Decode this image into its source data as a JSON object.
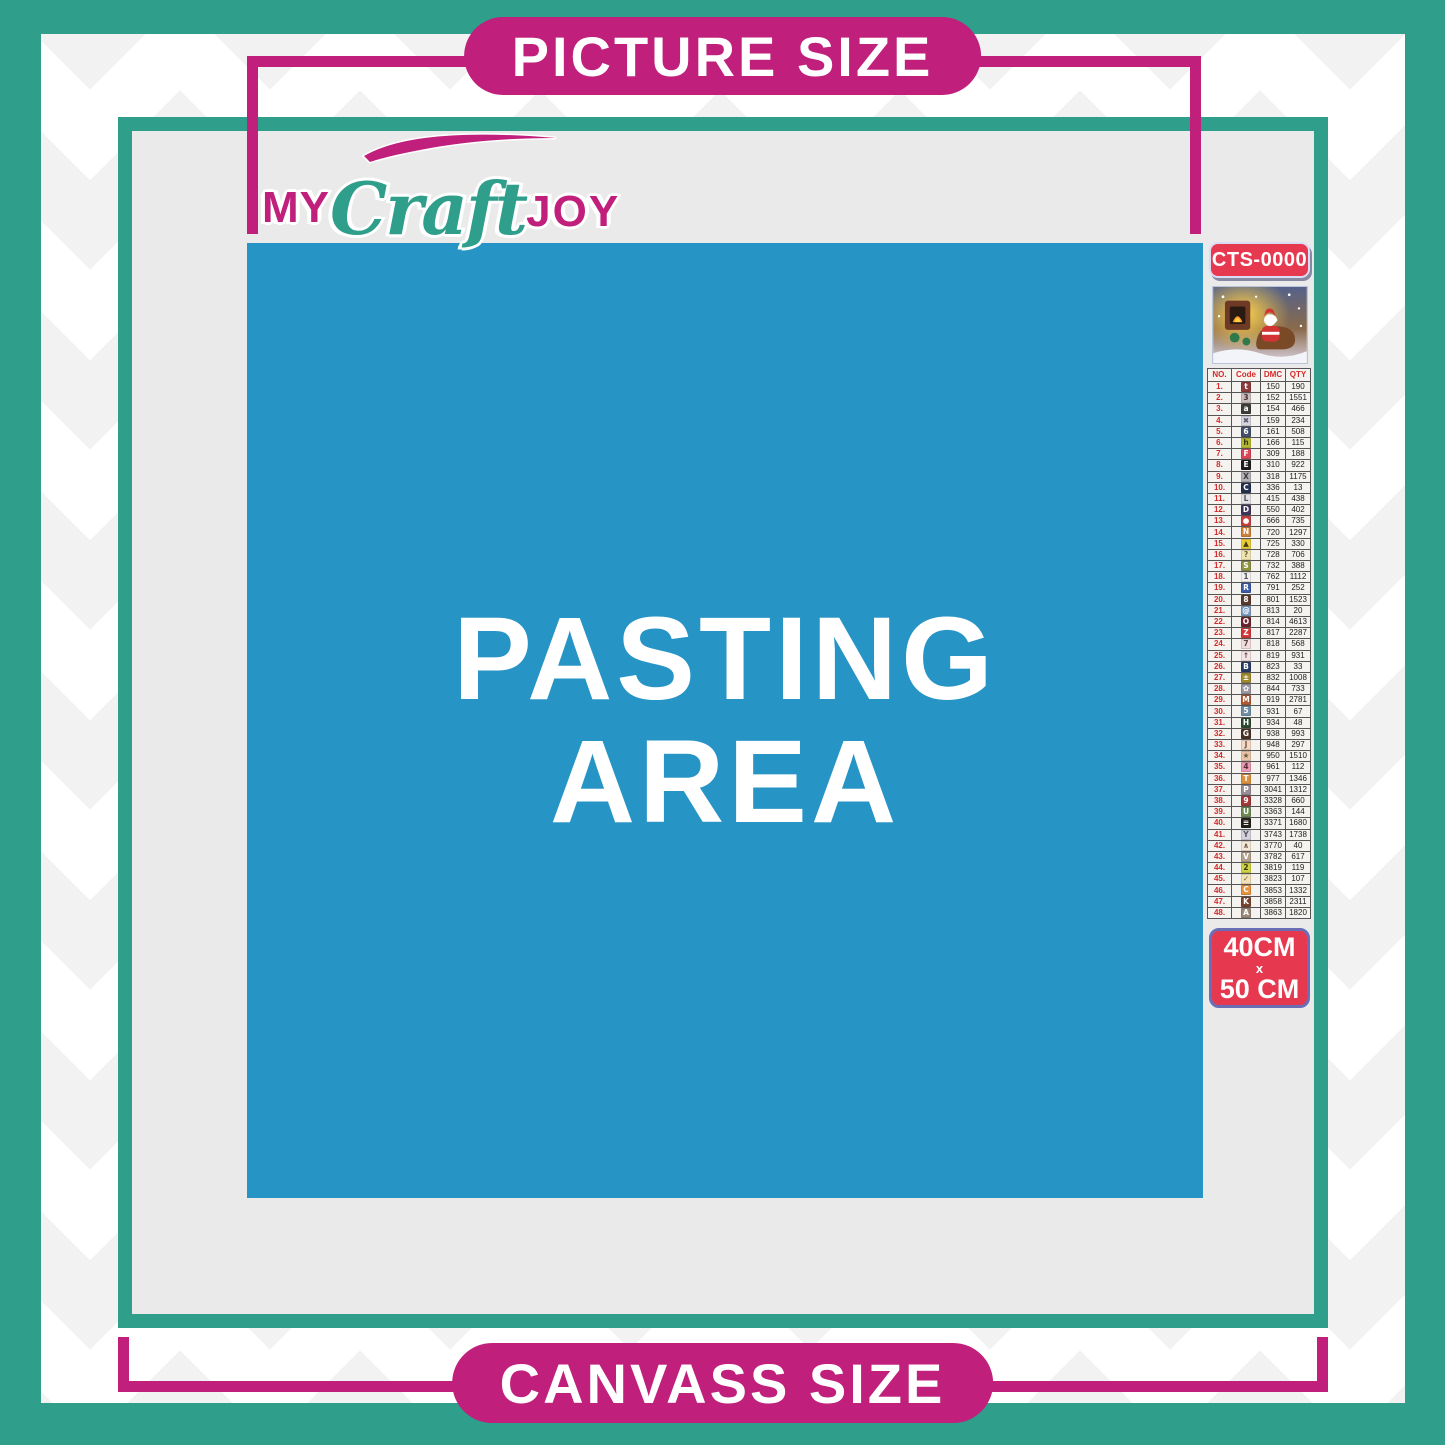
{
  "colors": {
    "teal": "#2F9E8B",
    "magenta": "#C01F7C",
    "pasting_blue": "#2794C6",
    "badge_red": "#E63950",
    "canvas_gray": "#EAEAEA"
  },
  "header": {
    "picture_size_label": "PICTURE SIZE"
  },
  "footer": {
    "canvass_size_label": "CANVASS SIZE"
  },
  "logo": {
    "part1": "MY",
    "part2": "Craft",
    "part3": "JOY"
  },
  "pasting_area": {
    "line1": "PASTING",
    "line2": "AREA"
  },
  "legend": {
    "sku": "CTS-0000",
    "size": {
      "line1": "40CM",
      "line2": "x",
      "line3": "50 CM"
    },
    "table": {
      "headers": [
        "NO.",
        "Code",
        "DMC",
        "QTY"
      ],
      "rows": [
        {
          "no": "1.",
          "symbol": "t",
          "bg": "#8E3B3B",
          "fg": "#FFFFFF",
          "dmc": "150",
          "qty": "190"
        },
        {
          "no": "2.",
          "symbol": "3",
          "bg": "#C9BDBD",
          "fg": "#4A3030",
          "dmc": "152",
          "qty": "1551"
        },
        {
          "no": "3.",
          "symbol": "a",
          "bg": "#403D3D",
          "fg": "#FFFFFF",
          "dmc": "154",
          "qty": "466"
        },
        {
          "no": "4.",
          "symbol": "✖",
          "bg": "#D6D4E0",
          "fg": "#5A5A6E",
          "dmc": "159",
          "qty": "234"
        },
        {
          "no": "5.",
          "symbol": "6",
          "bg": "#44506E",
          "fg": "#FFFFFF",
          "dmc": "161",
          "qty": "508"
        },
        {
          "no": "6.",
          "symbol": "h",
          "bg": "#B5B92F",
          "fg": "#3A3A10",
          "dmc": "166",
          "qty": "115"
        },
        {
          "no": "7.",
          "symbol": "F",
          "bg": "#D84858",
          "fg": "#FFFFFF",
          "dmc": "309",
          "qty": "188"
        },
        {
          "no": "8.",
          "symbol": "E",
          "bg": "#1E1E1E",
          "fg": "#FFFFFF",
          "dmc": "310",
          "qty": "922"
        },
        {
          "no": "9.",
          "symbol": "X",
          "bg": "#B3B1B8",
          "fg": "#3A3A3A",
          "dmc": "318",
          "qty": "1175"
        },
        {
          "no": "10.",
          "symbol": "C",
          "bg": "#23304F",
          "fg": "#FFFFFF",
          "dmc": "336",
          "qty": "13"
        },
        {
          "no": "11.",
          "symbol": "L",
          "bg": "#E3E3E6",
          "fg": "#55555E",
          "dmc": "415",
          "qty": "438"
        },
        {
          "no": "12.",
          "symbol": "D",
          "bg": "#41355C",
          "fg": "#FFFFFF",
          "dmc": "550",
          "qty": "402"
        },
        {
          "no": "13.",
          "symbol": "●",
          "bg": "#C84040",
          "fg": "#FFFFFF",
          "dmc": "666",
          "qty": "735"
        },
        {
          "no": "14.",
          "symbol": "N",
          "bg": "#CE8039",
          "fg": "#FFFFFF",
          "dmc": "720",
          "qty": "1297"
        },
        {
          "no": "15.",
          "symbol": "▲",
          "bg": "#E9CB3A",
          "fg": "#4A3E10",
          "dmc": "725",
          "qty": "330"
        },
        {
          "no": "16.",
          "symbol": "?",
          "bg": "#F0E3B2",
          "fg": "#6E6030",
          "dmc": "728",
          "qty": "706"
        },
        {
          "no": "17.",
          "symbol": "S",
          "bg": "#8F9344",
          "fg": "#FFFFFF",
          "dmc": "732",
          "qty": "388"
        },
        {
          "no": "18.",
          "symbol": "1",
          "bg": "#F2F0EE",
          "fg": "#555555",
          "dmc": "762",
          "qty": "1112"
        },
        {
          "no": "19.",
          "symbol": "R",
          "bg": "#3B5AA8",
          "fg": "#FFFFFF",
          "dmc": "791",
          "qty": "252"
        },
        {
          "no": "20.",
          "symbol": "8",
          "bg": "#5A3A2E",
          "fg": "#FFFFFF",
          "dmc": "801",
          "qty": "1523"
        },
        {
          "no": "21.",
          "symbol": "@",
          "bg": "#7B9BC0",
          "fg": "#FFFFFF",
          "dmc": "813",
          "qty": "20"
        },
        {
          "no": "22.",
          "symbol": "O",
          "bg": "#6E2430",
          "fg": "#FFFFFF",
          "dmc": "814",
          "qty": "4613"
        },
        {
          "no": "23.",
          "symbol": "Z",
          "bg": "#D23A3A",
          "fg": "#FFFFFF",
          "dmc": "817",
          "qty": "2287"
        },
        {
          "no": "24.",
          "symbol": "7",
          "bg": "#F2DCDC",
          "fg": "#5A4A4A",
          "dmc": "818",
          "qty": "568"
        },
        {
          "no": "25.",
          "symbol": "↑",
          "bg": "#F5E3E3",
          "fg": "#5A4A4A",
          "dmc": "819",
          "qty": "931"
        },
        {
          "no": "26.",
          "symbol": "B",
          "bg": "#2A3A66",
          "fg": "#FFFFFF",
          "dmc": "823",
          "qty": "33"
        },
        {
          "no": "27.",
          "symbol": "±",
          "bg": "#A08A2E",
          "fg": "#FFFFFF",
          "dmc": "832",
          "qty": "1008"
        },
        {
          "no": "28.",
          "symbol": "✿",
          "bg": "#9A97A0",
          "fg": "#FFFFFF",
          "dmc": "844",
          "qty": "733"
        },
        {
          "no": "29.",
          "symbol": "M",
          "bg": "#B05A33",
          "fg": "#FFFFFF",
          "dmc": "919",
          "qty": "2781"
        },
        {
          "no": "30.",
          "symbol": "5",
          "bg": "#6E8FA5",
          "fg": "#FFFFFF",
          "dmc": "931",
          "qty": "67"
        },
        {
          "no": "31.",
          "symbol": "H",
          "bg": "#2E4A33",
          "fg": "#FFFFFF",
          "dmc": "934",
          "qty": "48"
        },
        {
          "no": "32.",
          "symbol": "G",
          "bg": "#4A3326",
          "fg": "#FFFFFF",
          "dmc": "938",
          "qty": "993"
        },
        {
          "no": "33.",
          "symbol": "J",
          "bg": "#F5D8C4",
          "fg": "#6E5A4A",
          "dmc": "948",
          "qty": "297"
        },
        {
          "no": "34.",
          "symbol": "★",
          "bg": "#E9C4A8",
          "fg": "#6E5A42",
          "dmc": "950",
          "qty": "1510"
        },
        {
          "no": "35.",
          "symbol": "4",
          "bg": "#E89AB0",
          "fg": "#5A2A3A",
          "dmc": "961",
          "qty": "112"
        },
        {
          "no": "36.",
          "symbol": "T",
          "bg": "#D9913F",
          "fg": "#FFFFFF",
          "dmc": "977",
          "qty": "1346"
        },
        {
          "no": "37.",
          "symbol": "P",
          "bg": "#9A8C96",
          "fg": "#FFFFFF",
          "dmc": "3041",
          "qty": "1312"
        },
        {
          "no": "38.",
          "symbol": "9",
          "bg": "#A33A3A",
          "fg": "#FFFFFF",
          "dmc": "3328",
          "qty": "660"
        },
        {
          "no": "39.",
          "symbol": "U",
          "bg": "#6E8A55",
          "fg": "#FFFFFF",
          "dmc": "3363",
          "qty": "144"
        },
        {
          "no": "40.",
          "symbol": "≡",
          "bg": "#262019",
          "fg": "#FFFFFF",
          "dmc": "3371",
          "qty": "1680"
        },
        {
          "no": "41.",
          "symbol": "Y",
          "bg": "#D5D2DE",
          "fg": "#55555E",
          "dmc": "3743",
          "qty": "1738"
        },
        {
          "no": "42.",
          "symbol": "∧",
          "bg": "#F2E6D5",
          "fg": "#6E604A",
          "dmc": "3770",
          "qty": "40"
        },
        {
          "no": "43.",
          "symbol": "V",
          "bg": "#B3A08E",
          "fg": "#FFFFFF",
          "dmc": "3782",
          "qty": "617"
        },
        {
          "no": "44.",
          "symbol": "2",
          "bg": "#CFD23F",
          "fg": "#3A3A10",
          "dmc": "3819",
          "qty": "119"
        },
        {
          "no": "45.",
          "symbol": "✓",
          "bg": "#F2E2B8",
          "fg": "#6E6030",
          "dmc": "3823",
          "qty": "107"
        },
        {
          "no": "46.",
          "symbol": "C",
          "bg": "#E8913F",
          "fg": "#FFFFFF",
          "dmc": "3853",
          "qty": "1332"
        },
        {
          "no": "47.",
          "symbol": "K",
          "bg": "#7A4433",
          "fg": "#FFFFFF",
          "dmc": "3858",
          "qty": "2311"
        },
        {
          "no": "48.",
          "symbol": "A",
          "bg": "#9A8878",
          "fg": "#FFFFFF",
          "dmc": "3863",
          "qty": "1820"
        }
      ]
    }
  }
}
